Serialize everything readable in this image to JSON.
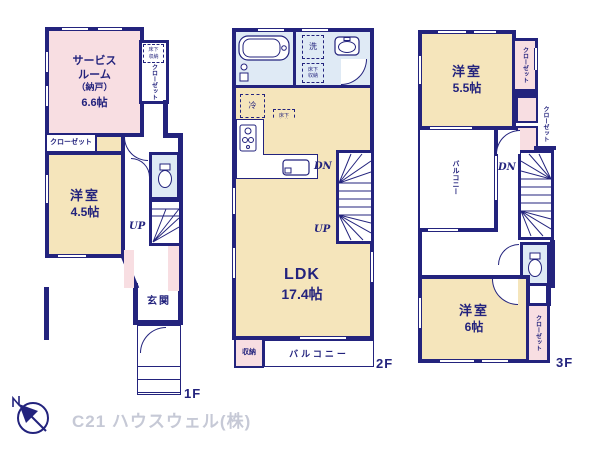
{
  "brand": {
    "name": "C21 ハウスウェル(株)",
    "compass_n": "N"
  },
  "floor1": {
    "label": "1F",
    "service_room": {
      "line1": "サービス",
      "line2": "ルーム",
      "line3": "（納戸）",
      "size": "6.6帖"
    },
    "underfloor_storage": "床下収納",
    "closet_vertical": "クローゼット",
    "closet_horizontal": "クローゼット",
    "western_room": {
      "name": "洋室",
      "size": "4.5帖"
    },
    "stairs_up": "UP",
    "entrance": "玄関"
  },
  "floor2": {
    "label": "2F",
    "laundry": "洗",
    "underfloor_storage_wash": "床下収納",
    "refrigerator": "冷",
    "underfloor_storage_ldk": "床下収納",
    "ldk": {
      "name": "LDK",
      "size": "17.4帖"
    },
    "stairs_down": "DN",
    "stairs_up": "UP",
    "storage": "収納",
    "balcony": "バルコニー"
  },
  "floor3": {
    "label": "3F",
    "western_room_55": {
      "name": "洋室",
      "size": "5.5帖"
    },
    "closet_top": "クローゼット",
    "closet_mid": "クローゼット",
    "closet_bottom": "クローゼット",
    "balcony": "バルコニー",
    "stairs_down": "DN",
    "western_room_6": {
      "name": "洋室",
      "size": "6帖"
    }
  },
  "colors": {
    "wall": "#23237d",
    "pink": "#f8dee2",
    "yellow": "#f5e5bb",
    "blue": "#dfeaf5",
    "brand_text": "#c6c9d6"
  }
}
